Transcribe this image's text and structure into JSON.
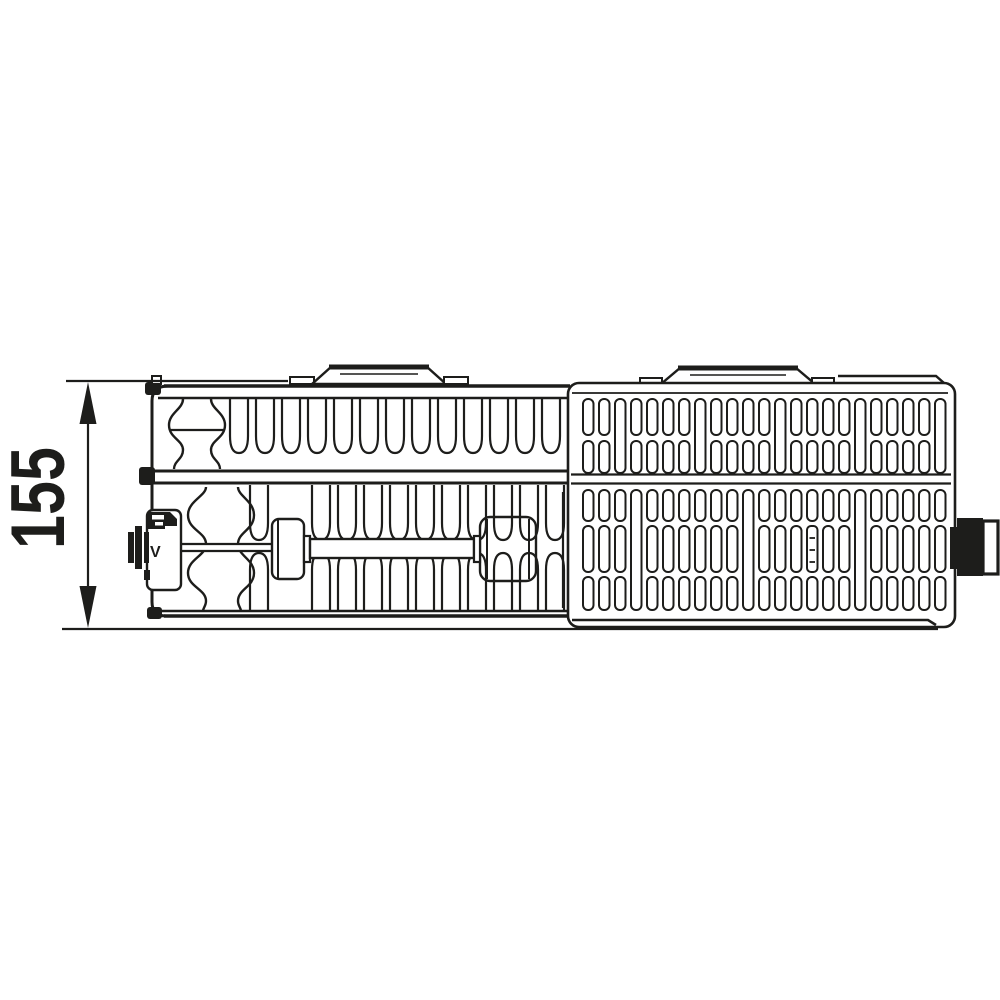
{
  "diagram": {
    "dimension_label": "155",
    "valve_mark": "V",
    "line_color": "#1d1d1b",
    "background_color": "#ffffff",
    "subject": "radiator-top-view-section-drawing"
  }
}
